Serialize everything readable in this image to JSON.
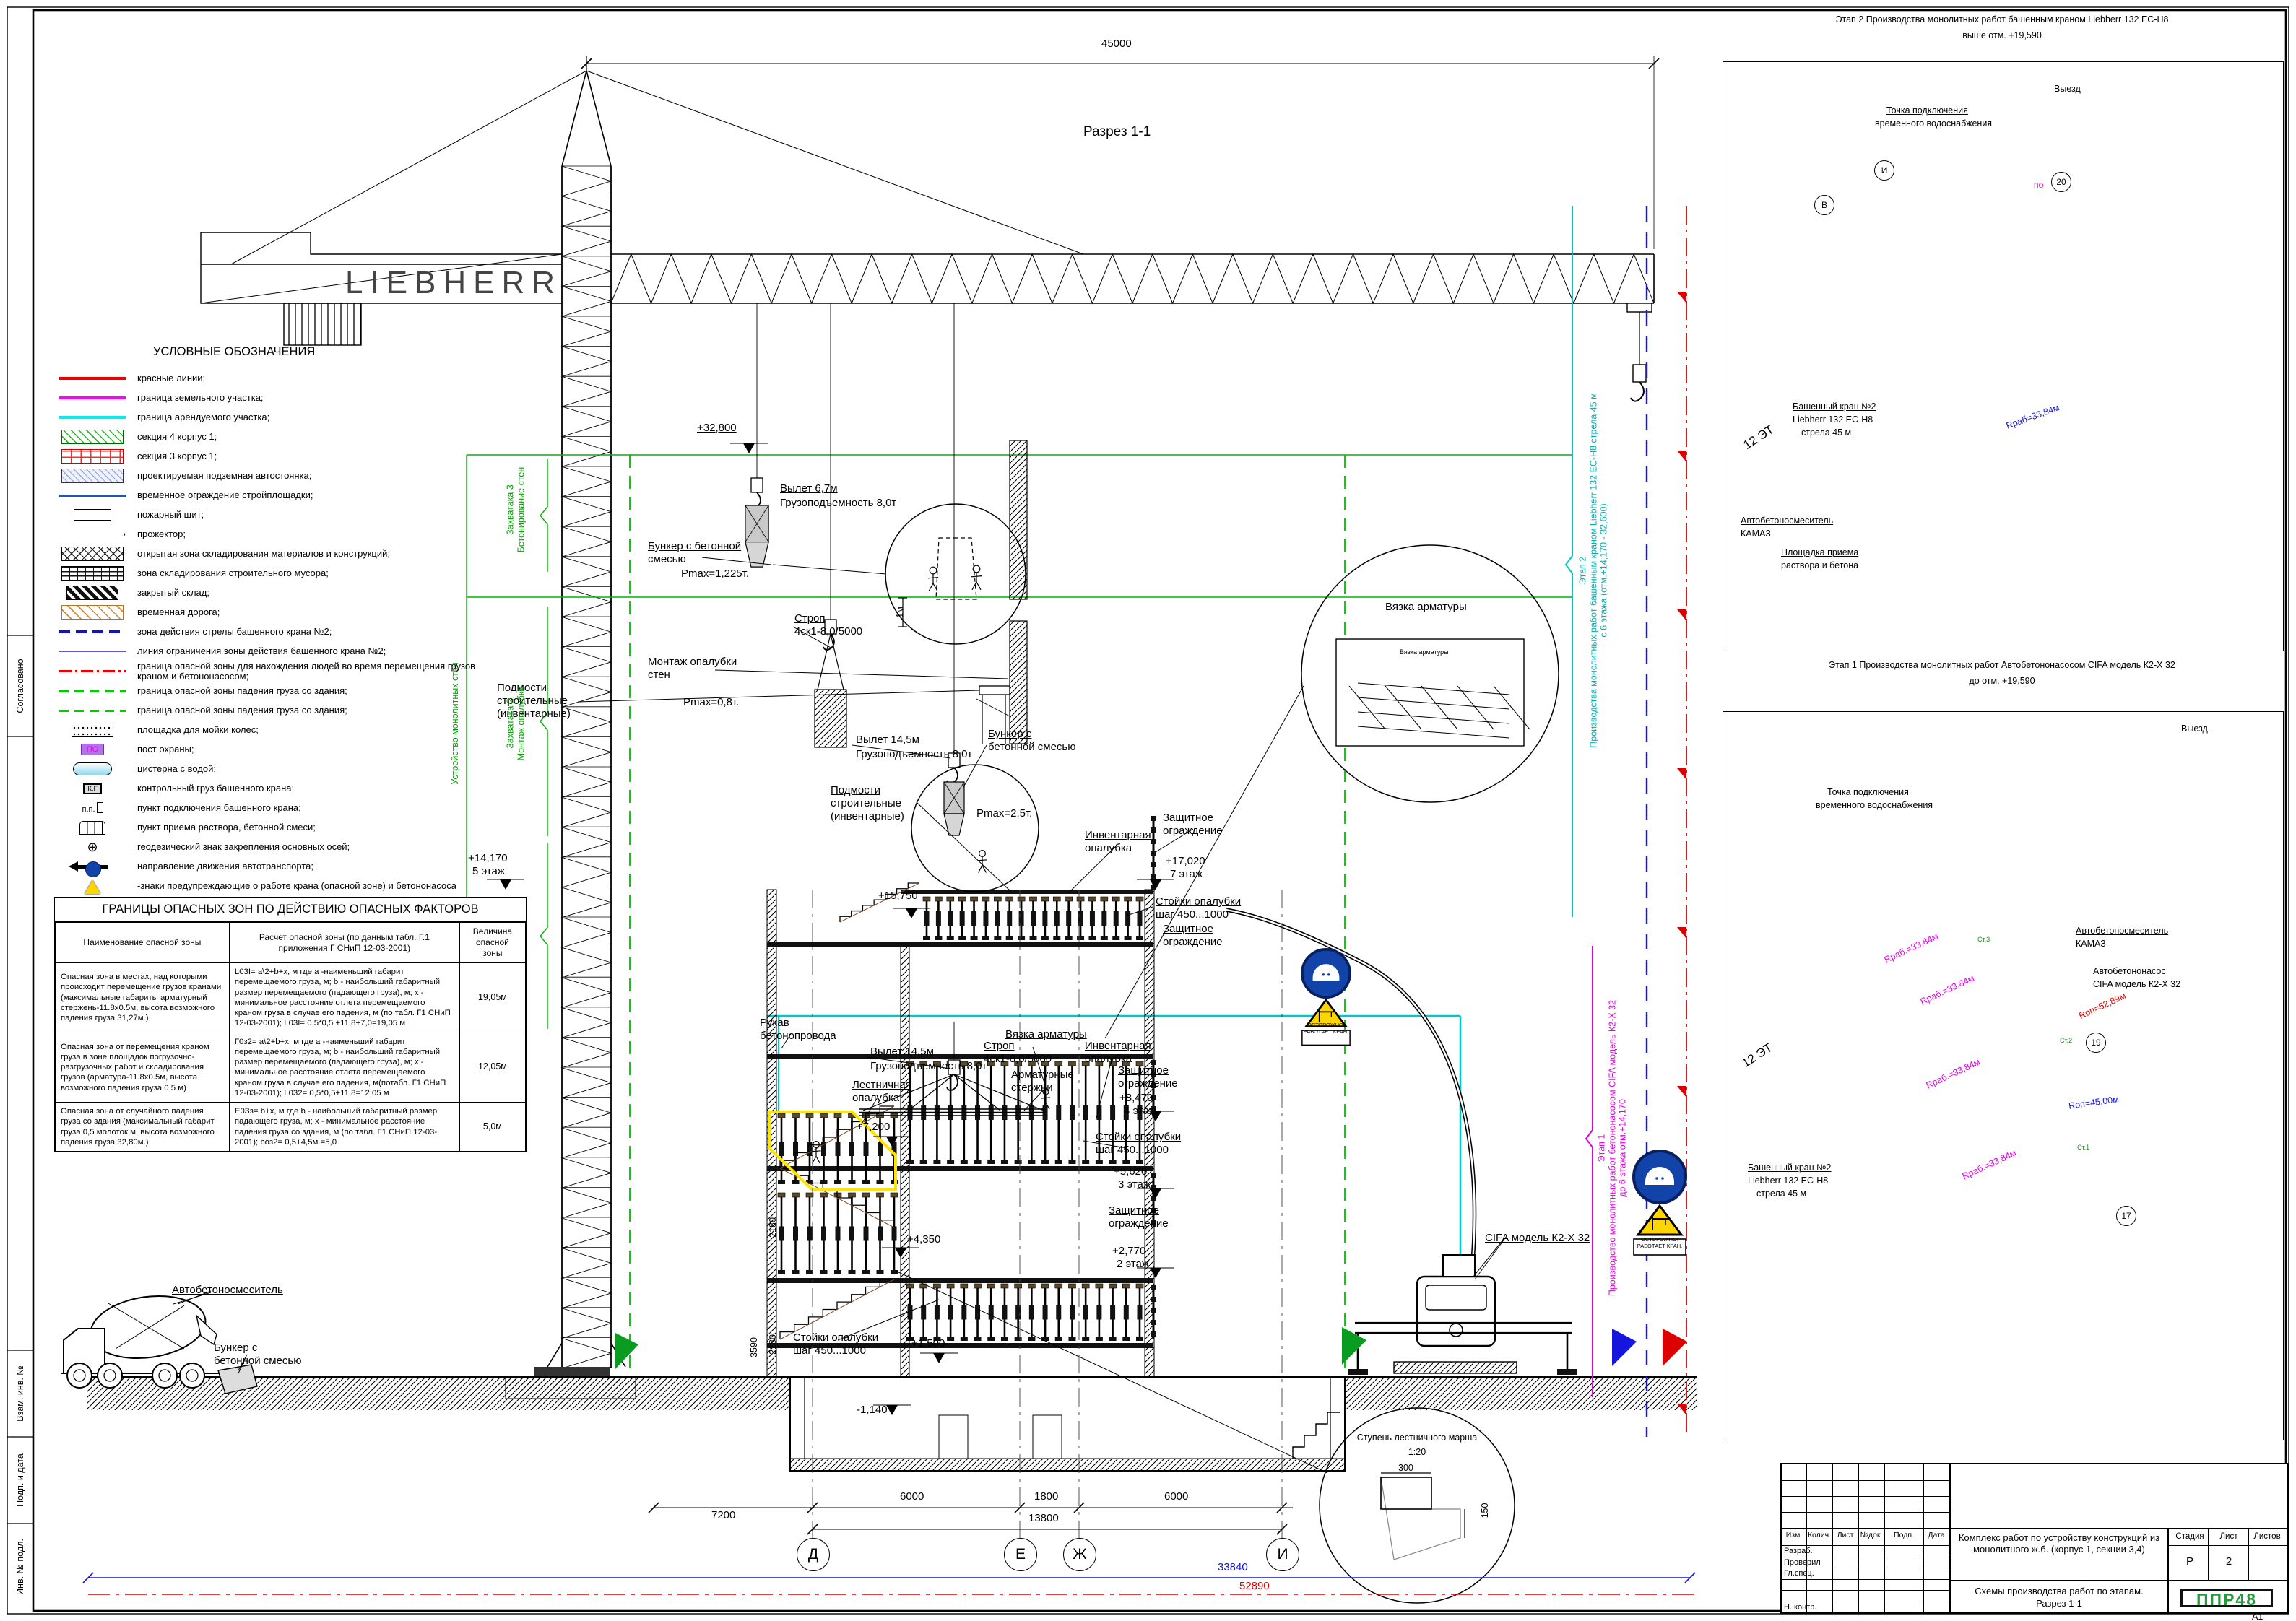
{
  "sheet": {
    "format": "А1"
  },
  "legend": {
    "title": "УСЛОВНЫЕ ОБОЗНАЧЕНИЯ",
    "items": [
      {
        "sym": "line-red",
        "label": "красные линии;",
        "sym_text": ""
      },
      {
        "sym": "line-mag",
        "label": "граница земельного участка;",
        "sym_text": ""
      },
      {
        "sym": "line-cyan",
        "label": "граница арендуемого участка;",
        "sym_text": ""
      },
      {
        "sym": "box-green",
        "label": "секция 4 корпус 1;",
        "sym_text": ""
      },
      {
        "sym": "box-redbrick",
        "label": "секция 3 корпус 1;",
        "sym_text": ""
      },
      {
        "sym": "box-underpark",
        "label": "проектируемая подземная автостоянка;",
        "sym_text": ""
      },
      {
        "sym": "line-blue",
        "label": "временное ограждение стройплощадки;",
        "sym_text": ""
      },
      {
        "sym": "box-fire",
        "label": "пожарный щит;",
        "sym_text": ""
      },
      {
        "sym": "floodlight",
        "label": "прожектор;",
        "sym_text": "◑"
      },
      {
        "sym": "box-cross",
        "label": "открытая зона складирования материалов и конструкций;",
        "sym_text": ""
      },
      {
        "sym": "box-brick",
        "label": "зона складирования строительного мусора;",
        "sym_text": ""
      },
      {
        "sym": "box-dark",
        "label": "закрытый склад;",
        "sym_text": ""
      },
      {
        "sym": "box-orange",
        "label": "временная дорога;",
        "sym_text": ""
      },
      {
        "sym": "line-bluedash",
        "label": "зона действия стрелы башенного крана №2;",
        "sym_text": ""
      },
      {
        "sym": "line-bluethin",
        "label": "линия ограничения зоны действия башенного крана №2;",
        "sym_text": ""
      },
      {
        "sym": "line-reddashdot",
        "label": "граница опасной зоны для нахождения людей во время перемещения грузов краном и бетононасосом;",
        "sym_text": ""
      },
      {
        "sym": "line-greendash",
        "label": "граница опасной зоны падения груза со здания;",
        "sym_text": ""
      },
      {
        "sym": "line-greendash",
        "label": "граница опасной зоны падения груза со здания;",
        "sym_text": ""
      },
      {
        "sym": "box-wash",
        "label": "площадка для мойки колес;",
        "sym_text": ""
      },
      {
        "sym": "box-po",
        "label": "пост охраны;",
        "sym_text": "ПО"
      },
      {
        "sym": "tank",
        "label": "цистерна с водой;",
        "sym_text": ""
      },
      {
        "sym": "box-kg",
        "label": "контрольный груз башенного крана;",
        "sym_text": "К.Г"
      },
      {
        "sym": "pp",
        "label": "пункт подключения башенного крана;",
        "sym_text": "п.п."
      },
      {
        "sym": "bins",
        "label": "пункт приема раствора, бетонной смеси;",
        "sym_text": ""
      },
      {
        "sym": "geo",
        "label": "геодезический знак закрепления основных осей;",
        "sym_text": "⊕"
      },
      {
        "sym": "arrow",
        "label": "направление движения автотранспорта;",
        "sym_text": ""
      },
      {
        "sym": "signs",
        "label": "-знаки предупреждающие о работе крана (опасной зоне) и бетононасоса",
        "sym_text": ""
      },
      {
        "sym": "plus",
        "label": "стоянки бетононасоса и миксера",
        "sym_text": "+"
      }
    ]
  },
  "hazard_table": {
    "title": "ГРАНИЦЫ ОПАСНЫХ ЗОН ПО ДЕЙСТВИЮ ОПАСНЫХ ФАКТОРОВ",
    "headers": [
      "Наименование опасной зоны",
      "Расчет опасной зоны (по данным табл. Г.1 приложения Г СНиП 12-03-2001)",
      "Величина опасной зоны"
    ],
    "rows": [
      {
        "name": "Опасная зона в местах, над которыми происходит перемещение грузов кранами (максимальные габариты арматурный стержень-11.8х0.5м, высота возможного падения груза 31,27м.)",
        "calc": "L03I= а\\2+b+х, м  где а -наименьший габарит перемещаемого груза, м; b - наибольший габаритный размер перемещаемого (падающего груза), м; х - минимальное расстояние отлета перемещаемого краном груза в случае его падения, м (по табл. Г1 СНиП 12-03-2001); L03I= 0,5*0,5 +11,8+7,0=19,05 м",
        "value": "19,05м"
      },
      {
        "name": "Опасная зона от перемещения краном груза в зоне площадок погрузочно-разгрузочных работ и складирования грузов (арматура-11.8х0.5м, высота возможного падения груза 0,5 м)",
        "calc": "Г0з2= а\\2+b+х, м  где а -наименьший габарит перемещаемого груза, м; b - наибольший габаритный размер перемещаемого (падающего груза), м; х - минимальное расстояние отлета перемещаемого краном груза в случае его падения, м(потабл. Г1 СНиП 12-03-2001); L032= 0,5*0,5+11,8=12,05 м",
        "value": "12,05м"
      },
      {
        "name": "Опасная зона от случайного падения груза со здания (максимальный габарит груза 0,5 молоток м, высота возможного падения груза 32,80м.)",
        "calc": "Е0Зз= b+х, м  где b - наибольший габаритный размер падающего груза, м; х - минимальное расстояние падения груза со здания, м (по табл. Г1 СНиП 12-03-2001); bоз2= 0,5+4,5м.=5,0",
        "value": "5,0м"
      }
    ]
  },
  "section": {
    "title": "Разрез 1-1",
    "crane_brand": "LIEBHERR",
    "dim_total": "45000",
    "ann": {
      "vylet67": "Вылет 6,7м",
      "gruz8": "Грузоподъемность 8,0т",
      "bunker_l1": "Бункер с бетонной",
      "bunker_l2": "смесью",
      "pmax1225": "Pmax=1,225т.",
      "bunker2_l1": "Бункер с",
      "bunker2_l2": "бетонной смесью",
      "pmax25": "Pmax=2,5т.",
      "bunker3_l1": "Бункер с",
      "bunker3_l2": "бетонной смесью",
      "strop_l1": "Строп",
      "strop_l2": "4ск1-8,0/5000",
      "montazh_l1": "Монтаж опалубки",
      "montazh_l2": "стен",
      "pmax08": "Pmax=0,8т.",
      "vylet145": "Вылет 14,5м",
      "podmosti_l1": "Подмости",
      "podmosti_l2": "строительные",
      "podmosti_l3": "(инвентарные)",
      "invent_l1": "Инвентарная",
      "invent_l2": "опалубка",
      "zashch_l1": "Защитное",
      "zashch_l2": "ограждение",
      "stoiki_l1": "Стойки опалубки",
      "stoiki_l2": "шаг 450...1000",
      "vyazka": "Вязка арматуры",
      "armat_l1": "Арматурные",
      "armat_l2": "стержни",
      "lestn_l1": "Лестничная",
      "lestn_l2": "опалубка",
      "rukav_l1": "Рукав",
      "rukav_l2": "бетонопровода",
      "cifa": "CIFA модель К2-Х 32",
      "mixer": "Автобетоносмеситель"
    },
    "levels": {
      "l32800": "+32,800",
      "l17020": "+17,020",
      "f7": "7 этаж",
      "l15750": "+15,750",
      "l14170": "+14,170",
      "f5": "5 этаж",
      "l11350": "+11,350",
      "l8470": "+8,470",
      "f4": "4 этаж",
      "l7200": "+7,200",
      "l5620": "+5,620",
      "f3": "3 этаж",
      "l4350": "+4,350",
      "l2770": "+2,770",
      "f2": "2 этаж",
      "l1500": "+1,500",
      "lm1140": "-1,140"
    },
    "dims": {
      "d2180": "2180",
      "d3590": "3590",
      "d7200": "7200",
      "d6000": "6000",
      "d1800": "1800",
      "d13800": "13800",
      "d33840": "33840",
      "d52890": "52890",
      "d300": "300",
      "d150": "150",
      "d1m": "1м"
    },
    "axes": [
      "Д",
      "Е",
      "Ж",
      "И"
    ],
    "zahvatki": [
      {
        "num": "Захватака 3",
        "task": "Бетонирование стен"
      },
      {
        "num": "Захватака 2",
        "task": "Монтаж опалубки"
      },
      {
        "num": "Захватака 1",
        "task": "Монтаж арматуры"
      }
    ],
    "ustroystvo": "Устройство монолитных стен",
    "stages": {
      "s2_num": "Этап 2",
      "s2_text": "Производства монолитных работ башенным краном Liebherr 132 EC-H8 стрела 45 м",
      "s2_range": "с 6 этажа  (отм.+14,170 - 32,600)",
      "s1_num": "Этап 1",
      "s1_text": "Производство монолитных работ бетононасосом CIFA модель К2-Х 32",
      "s1_range": "до 6 этажа отм.+14,170"
    },
    "signs": {
      "caution1": "ОСТОРОЖНО!",
      "caution2": "РАБОТАЕТ КРАН."
    },
    "detail_stair": {
      "t1": "Ступень лестничного марша",
      "t2": "1:20"
    },
    "detail_rebar": "Вязка арматуры"
  },
  "plans": {
    "plan2": {
      "title": "Этап 2 Производства монолитных работ башенным краном  Liebherr 132 EC-H8",
      "subtitle": "выше отм. +19,590",
      "water1": "Точка подключения",
      "water2": "временного водоснабжения",
      "exit": "Выезд",
      "crane1": "Башенный кран №2",
      "crane2": "Liebherr 132 EC-H8",
      "crane3": "стрела 45 м",
      "mixer1": "Автобетоносмеситель",
      "mixer2": "КАМАЗ",
      "platform1": "Площадка приема",
      "platform2": "раствора и бетона",
      "radius": "Rраб=33,84м",
      "bld": "12 ЭТ",
      "po": "ПО",
      "axis1": "И",
      "axis2": "В",
      "n20": "20"
    },
    "plan1": {
      "title": "Этап 1 Производства монолитных работ Автобетононасосом  CIFA модель К2-Х 32",
      "subtitle": "до отм. +19,590",
      "water1": "Точка подключения",
      "water2": "временного водоснабжения",
      "exit": "Выезд",
      "mixer1": "Автобетоносмеситель",
      "mixer2": "КАМАЗ",
      "pump1": "Автобетононасос",
      "pump2": "CIFA модель К2-Х 32",
      "crane1": "Башенный кран №2",
      "crane2": "Liebherr 132 EC-H8",
      "crane3": "стрела 45 м",
      "r_rab": "Rраб.=33,84м",
      "r_op1": "Rоп=52,89м",
      "r_op2": "Rоп=45,00м",
      "st1": "Ст.1",
      "st2": "Ст.2",
      "st3": "Ст.3",
      "bld": "12 ЭТ",
      "n19": "19",
      "n17": "17"
    }
  },
  "titleblock": {
    "cols": [
      "Изм.",
      "Колич.",
      "Лист",
      "№док.",
      "Подп.",
      "Дата"
    ],
    "roles": [
      "Разраб.",
      "Проверил",
      "Гл.спец.",
      "",
      "",
      "Н. контр."
    ],
    "title": "Комплекс работ по устройству конструкций из монолитного ж.б.  (корпус 1, секции 3,4)",
    "subtitle1": "Схемы производства работ по этапам.",
    "subtitle2": "Разрез 1-1",
    "stage_h": "Стадия",
    "list_h": "Лист",
    "listov_h": "Листов",
    "stage": "Р",
    "list": "2",
    "listov": "",
    "logo": "ППР48"
  },
  "side": {
    "items": [
      "Согласовано",
      "Взам. инв. №",
      "Подп. и дата",
      "Инв. № подл."
    ]
  }
}
